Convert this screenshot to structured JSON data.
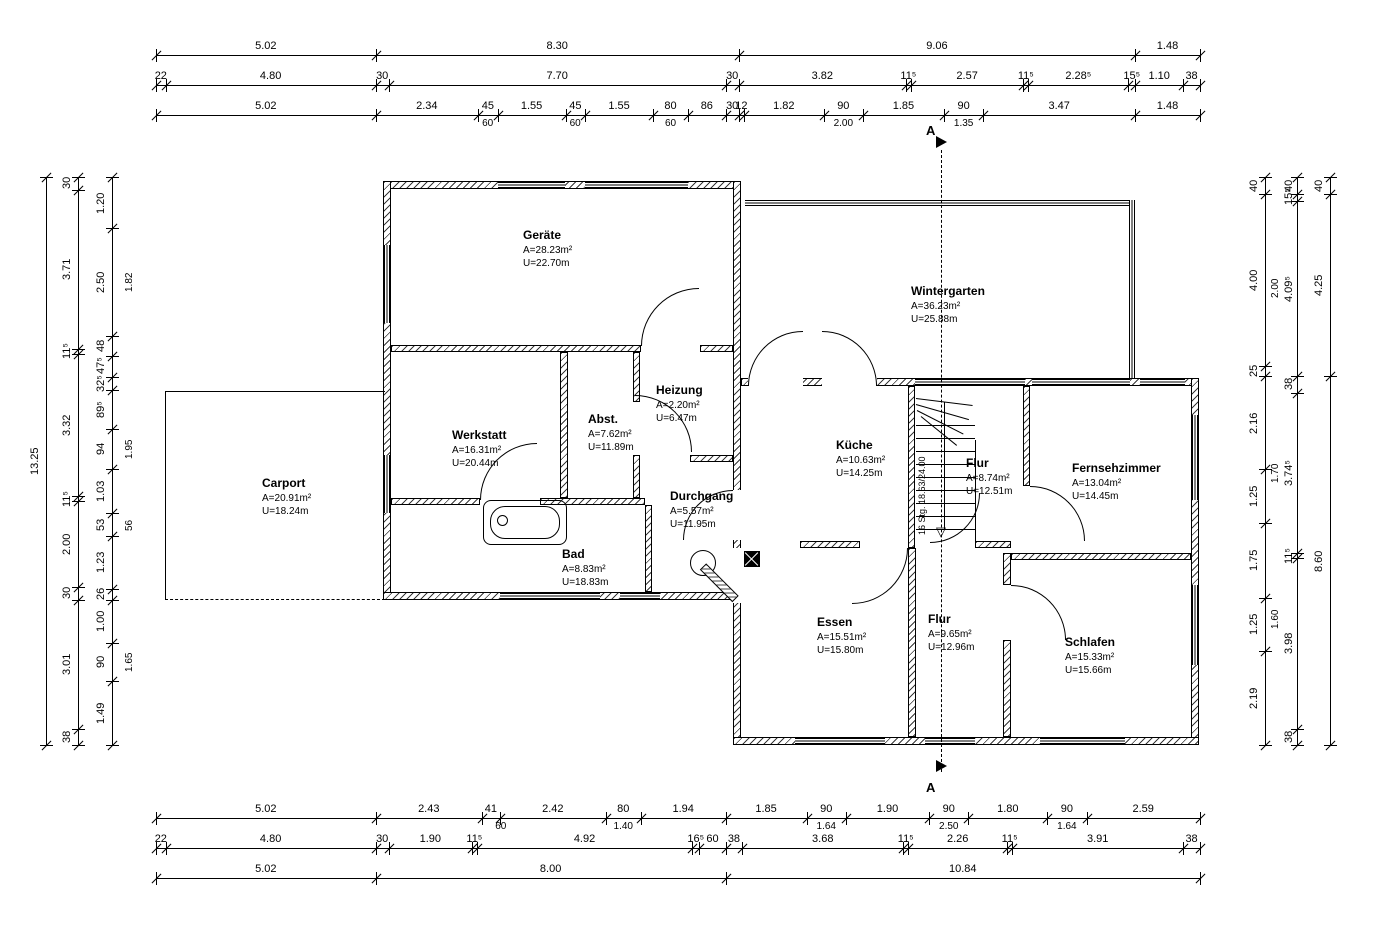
{
  "section": {
    "label": "A"
  },
  "stair": {
    "note": "16 Stg. 18.63/24.00"
  },
  "rooms": [
    {
      "name": "Geräte",
      "area": "A=28.23m²",
      "perimeter": "U=22.70m"
    },
    {
      "name": "Wintergarten",
      "area": "A=36.23m²",
      "perimeter": "U=25.88m"
    },
    {
      "name": "Werkstatt",
      "area": "A=16.31m²",
      "perimeter": "U=20.44m"
    },
    {
      "name": "Abst.",
      "area": "A=7.62m²",
      "perimeter": "U=11.89m"
    },
    {
      "name": "Heizung",
      "area": "A=2.20m²",
      "perimeter": "U=6.47m"
    },
    {
      "name": "Carport",
      "area": "A=20.91m²",
      "perimeter": "U=18.24m"
    },
    {
      "name": "Bad",
      "area": "A=8.83m²",
      "perimeter": "U=18.83m"
    },
    {
      "name": "Durchgang",
      "area": "A=5.57m²",
      "perimeter": "U=11.95m"
    },
    {
      "name": "Küche",
      "area": "A=10.63m²",
      "perimeter": "U=14.25m"
    },
    {
      "name": "Flur",
      "area": "A=8.74m²",
      "perimeter": "U=12.51m"
    },
    {
      "name": "Fernsehzimmer",
      "area": "A=13.04m²",
      "perimeter": "U=14.45m"
    },
    {
      "name": "Essen",
      "area": "A=15.51m²",
      "perimeter": "U=15.80m"
    },
    {
      "name": "Flur",
      "area": "A=9.65m²",
      "perimeter": "U=12.96m"
    },
    {
      "name": "Schlafen",
      "area": "A=15.33m²",
      "perimeter": "U=15.66m"
    }
  ],
  "dims": {
    "h_scale": 43.75,
    "v_scale": 42.87,
    "h_chains": [
      {
        "y": 55,
        "x0": 156,
        "segs": [
          [
            "5.02",
            5.02
          ],
          [
            "8.30",
            8.3
          ],
          [
            "9.06",
            9.06
          ],
          [
            "1.48",
            1.48
          ]
        ]
      },
      {
        "y": 85,
        "x0": 156,
        "segs": [
          [
            "22",
            0.22
          ],
          [
            "4.80",
            4.8
          ],
          [
            "30",
            0.3
          ],
          [
            "7.70",
            7.7
          ],
          [
            "30",
            0.3
          ],
          [
            "3.82",
            3.82
          ],
          [
            "11⁵",
            0.115
          ],
          [
            "2.57",
            2.57
          ],
          [
            "11⁵",
            0.115
          ],
          [
            "2.28⁵",
            2.285
          ],
          [
            "15⁵",
            0.155
          ],
          [
            "1.10",
            1.1
          ],
          [
            "38",
            0.38
          ]
        ]
      },
      {
        "y": 115,
        "x0": 156,
        "segs": [
          [
            "5.02",
            5.02
          ],
          [
            "2.34",
            2.34
          ],
          [
            "45",
            0.45
          ],
          [
            "1.55",
            1.55
          ],
          [
            "45",
            0.45
          ],
          [
            "1.55",
            1.55
          ],
          [
            "80",
            0.8
          ],
          [
            "86",
            0.86
          ],
          [
            "30",
            0.3
          ],
          [
            "12",
            0.12
          ],
          [
            "1.82",
            1.82
          ],
          [
            "90",
            0.9
          ],
          [
            "1.85",
            1.85
          ],
          [
            "90",
            0.9
          ],
          [
            "3.47",
            3.47
          ],
          [
            "1.48",
            1.48
          ]
        ],
        "subs": [
          [
            "60",
            7.58
          ],
          [
            "60",
            9.58
          ],
          [
            "60",
            11.76
          ],
          [
            "2.00",
            15.71
          ],
          [
            "1.35",
            18.46
          ]
        ]
      },
      {
        "y": 818,
        "x0": 156,
        "segs": [
          [
            "5.02",
            5.02
          ],
          [
            "2.43",
            2.43
          ],
          [
            "41",
            0.41
          ],
          [
            "2.42",
            2.42
          ],
          [
            "80",
            0.8
          ],
          [
            "1.94",
            1.94
          ],
          [
            "1.85",
            1.85
          ],
          [
            "90",
            0.9
          ],
          [
            "1.90",
            1.9
          ],
          [
            "90",
            0.9
          ],
          [
            "1.80",
            1.8
          ],
          [
            "90",
            0.9
          ],
          [
            "2.59",
            2.59
          ]
        ],
        "subs": [
          [
            "60",
            7.88
          ],
          [
            "1.40",
            10.68
          ],
          [
            "1.64",
            15.32
          ],
          [
            "2.50",
            18.12
          ],
          [
            "1.64",
            20.82
          ]
        ]
      },
      {
        "y": 848,
        "x0": 156,
        "segs": [
          [
            "22",
            0.22
          ],
          [
            "4.80",
            4.8
          ],
          [
            "30",
            0.3
          ],
          [
            "1.90",
            1.9
          ],
          [
            "11⁵",
            0.115
          ],
          [
            "4.92",
            4.92
          ],
          [
            "16⁵",
            0.165
          ],
          [
            "60",
            0.6
          ],
          [
            "38",
            0.38
          ],
          [
            "3.68",
            3.68
          ],
          [
            "11⁵",
            0.115
          ],
          [
            "2.26",
            2.26
          ],
          [
            "11⁵",
            0.115
          ],
          [
            "3.91",
            3.91
          ],
          [
            "38",
            0.38
          ]
        ]
      },
      {
        "y": 878,
        "x0": 156,
        "segs": [
          [
            "5.02",
            5.02
          ],
          [
            "8.00",
            8.0
          ],
          [
            "10.84",
            10.84
          ]
        ]
      }
    ],
    "v_chains": [
      {
        "x": 46,
        "y0": 177,
        "dx": -17,
        "segs": [
          [
            "13.25",
            13.25
          ]
        ]
      },
      {
        "x": 78,
        "y0": 177,
        "dx": -17,
        "segs": [
          [
            "30",
            0.3
          ],
          [
            "3.71",
            3.71
          ],
          [
            "11⁵",
            0.115
          ],
          [
            "3.32",
            3.32
          ],
          [
            "11⁵",
            0.115
          ],
          [
            "2.00",
            2.0
          ],
          [
            "30",
            0.3
          ],
          [
            "3.01",
            3.01
          ],
          [
            "38",
            0.38
          ]
        ]
      },
      {
        "x": 112,
        "y0": 177,
        "dx": -17,
        "subdx": 12,
        "segs": [
          [
            "1.20",
            1.2
          ],
          [
            "2.50",
            2.5
          ],
          [
            "48",
            0.48
          ],
          [
            "47⁵",
            0.475
          ],
          [
            "32⁵",
            0.325
          ],
          [
            "89⁵",
            0.895
          ],
          [
            "94",
            0.94
          ],
          [
            "1.03",
            1.03
          ],
          [
            "53",
            0.53
          ],
          [
            "1.23",
            1.23
          ],
          [
            "26",
            0.26
          ],
          [
            "1.00",
            1.0
          ],
          [
            "90",
            0.9
          ],
          [
            "1.49",
            1.485
          ]
        ],
        "subs": [
          [
            "1.82",
            2.45
          ],
          [
            "1.95",
            6.35
          ],
          [
            "56",
            8.11
          ],
          [
            "1.65",
            11.32
          ]
        ]
      },
      {
        "x": 1265,
        "y0": 177,
        "dx": -17,
        "segs": [
          [
            "40",
            0.4
          ],
          [
            "4.00",
            4.0
          ],
          [
            "25",
            0.25
          ],
          [
            "2.16",
            2.16
          ],
          [
            "1.25",
            1.25
          ],
          [
            "1.75",
            1.75
          ],
          [
            "1.25",
            1.25
          ],
          [
            "2.19",
            2.19
          ]
        ]
      },
      {
        "x": 1297,
        "y0": 177,
        "dx": -14,
        "subdx": -27,
        "segs": [
          [
            "40",
            0.4
          ],
          [
            "15⁵",
            0.155
          ],
          [
            "4.09⁵",
            4.095
          ],
          [
            "38",
            0.38
          ],
          [
            "3.74⁵",
            3.745
          ],
          [
            "11⁵",
            0.115
          ],
          [
            "3.98",
            3.98
          ],
          [
            "38",
            0.38
          ]
        ],
        "subs": [
          [
            "2.00",
            2.6
          ],
          [
            "1.70",
            6.9
          ],
          [
            "1.60",
            10.3
          ]
        ]
      },
      {
        "x": 1330,
        "y0": 177,
        "dx": -17,
        "segs": [
          [
            "40",
            0.4
          ],
          [
            "4.25",
            4.25
          ],
          [
            "8.60",
            8.6
          ]
        ]
      }
    ]
  }
}
